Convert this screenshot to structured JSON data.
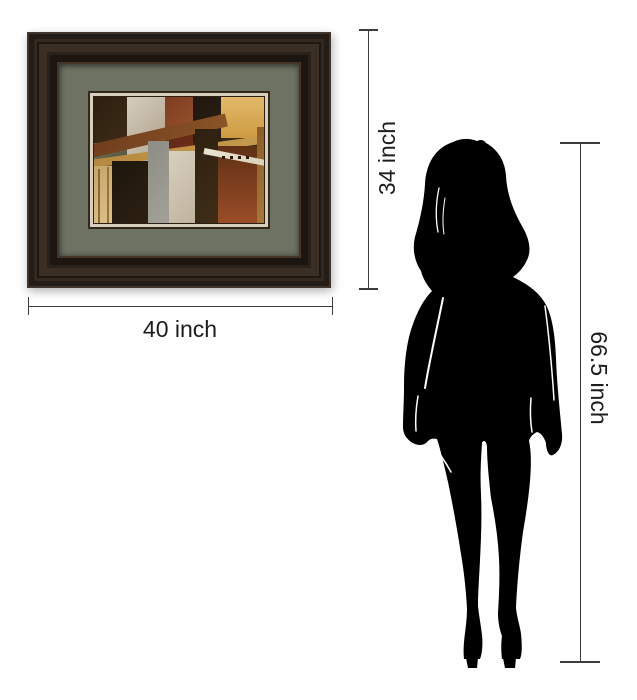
{
  "labels": {
    "frame_width": "40 inch",
    "frame_height": "34 inch",
    "person_height": "66.5 inch"
  },
  "figure": {
    "name": "standing-woman-silhouette"
  },
  "colors": {
    "background": "#ffffff",
    "line": "#3c3c3c",
    "text": "#1d1d1d",
    "silhouette": "#000000",
    "mat": "#6d7263",
    "liner_cream": "#d7cfbd",
    "liner_brown": "#342619",
    "frame_edge": "#42362c",
    "frame_dark": "#241c16",
    "frame_band": "#3b2e25",
    "frame_deep": "#1d1610",
    "frame_lip": "#453528"
  },
  "artwork": {
    "blocks": [
      {
        "x": 0,
        "y": 0,
        "w": 33,
        "h": 46,
        "c1": "#2c1e10",
        "c2": "#3c2b16"
      },
      {
        "x": 33,
        "y": 0,
        "w": 38,
        "h": 44,
        "c1": "#d5cdbc",
        "c2": "#b3a692"
      },
      {
        "x": 71,
        "y": 0,
        "w": 28,
        "h": 33,
        "c1": "#7e3b20",
        "c2": "#96522d"
      },
      {
        "x": 99,
        "y": 0,
        "w": 29,
        "h": 45,
        "c1": "#1f160f",
        "c2": "#2f2114"
      },
      {
        "x": 127,
        "y": 0,
        "w": 43,
        "h": 41,
        "c1": "#e3ba6b",
        "c2": "#cd9a42",
        "g": 180
      },
      {
        "x": 0,
        "y": 46,
        "w": 33,
        "h": 23,
        "c1": "#6b6a52",
        "c2": "#555540"
      },
      {
        "x": 33,
        "y": 44,
        "w": 38,
        "h": 35,
        "c1": "#cbc2af",
        "c2": "#a99d8c"
      },
      {
        "x": 71,
        "y": 33,
        "w": 28,
        "h": 32,
        "c1": "#5e2516",
        "c2": "#73301b"
      },
      {
        "x": 99,
        "y": 45,
        "w": 29,
        "h": 21,
        "c1": "#362515",
        "c2": "#443120"
      },
      {
        "x": -4,
        "y": 48,
        "w": 140,
        "h": 13,
        "r": -13,
        "c1": "#6f3d1e",
        "c2": "#8a5426"
      },
      {
        "x": -4,
        "y": 63,
        "w": 180,
        "h": 8,
        "r": -8,
        "c1": "#b5883f",
        "c2": "#c79b4d"
      },
      {
        "x": 0,
        "y": 69,
        "w": 18,
        "h": 57,
        "c1": "#c7a569",
        "c2": "#dec189"
      },
      {
        "x": 4,
        "y": 72,
        "w": 2,
        "h": 54,
        "c1": "#8a6a38",
        "c2": "#8a6a38"
      },
      {
        "x": 13,
        "y": 70,
        "w": 2,
        "h": 56,
        "c1": "#97743c",
        "c2": "#97743c"
      },
      {
        "x": 18,
        "y": 64,
        "w": 36,
        "h": 62,
        "c1": "#1e160d",
        "c2": "#2c2011"
      },
      {
        "x": 54,
        "y": 44,
        "w": 21,
        "h": 82,
        "c1": "#8d8d85",
        "c2": "#a3a197"
      },
      {
        "x": 75,
        "y": 54,
        "w": 32,
        "h": 72,
        "c1": "#d8cfbe",
        "c2": "#bfb29e"
      },
      {
        "x": 101,
        "y": 32,
        "w": 23,
        "h": 94,
        "c1": "#2e1f10",
        "c2": "#3f2d17"
      },
      {
        "x": 124,
        "y": 49,
        "w": 39,
        "h": 77,
        "c1": "#5f3016",
        "c2": "#9a4d27",
        "g": 180
      },
      {
        "x": 163,
        "y": 30,
        "w": 7,
        "h": 96,
        "c1": "#8a5d28",
        "c2": "#a87838"
      },
      {
        "x": 110,
        "y": 51,
        "w": 64,
        "h": 6,
        "r": 11,
        "c1": "#ece4d1",
        "c2": "#d9d0b8"
      },
      {
        "x": 128,
        "y": 59,
        "w": 3,
        "h": 3,
        "c1": "#2a1a0c",
        "c2": "#2a1a0c"
      },
      {
        "x": 136,
        "y": 59,
        "w": 3,
        "h": 3,
        "c1": "#2a1a0c",
        "c2": "#2a1a0c"
      },
      {
        "x": 144,
        "y": 59,
        "w": 3,
        "h": 3,
        "c1": "#2a1a0c",
        "c2": "#2a1a0c"
      },
      {
        "x": 152,
        "y": 59,
        "w": 3,
        "h": 3,
        "c1": "#2a1a0c",
        "c2": "#2a1a0c"
      }
    ]
  }
}
